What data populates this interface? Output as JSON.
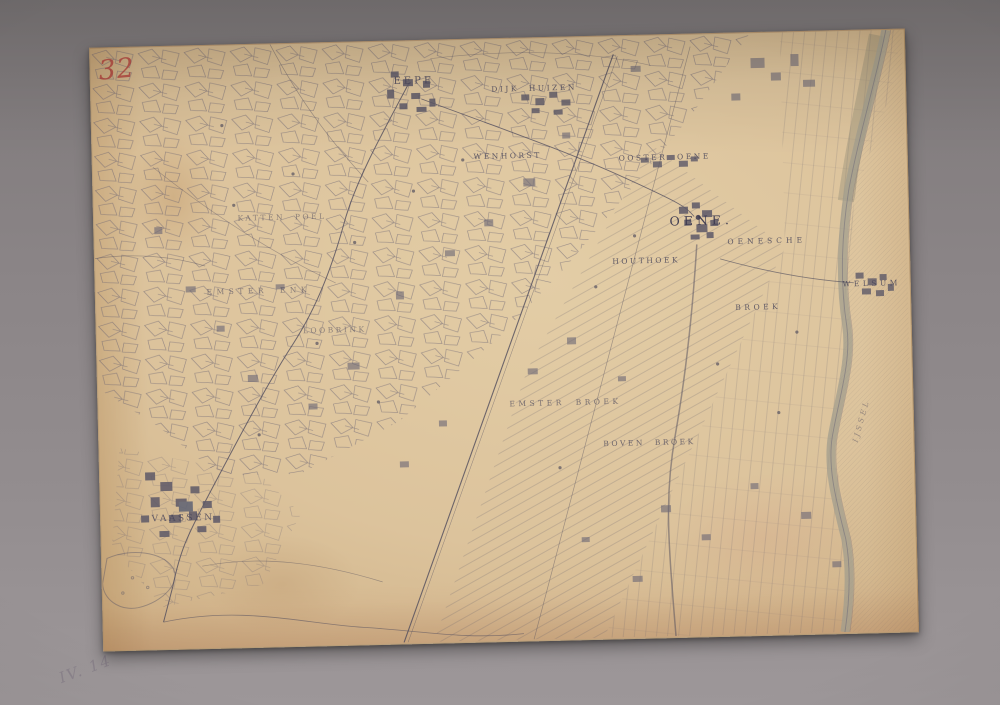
{
  "photo": {
    "pencil_note": "IV. 14",
    "background_color": "#8b8587"
  },
  "map": {
    "sheet_number": "32",
    "colors": {
      "paper": "#dcc39c",
      "ink": "#56525f",
      "sheet_number_red": "#b03e38",
      "river": "#a19d8e"
    },
    "labels": {
      "eepe": {
        "text": "EEPE"
      },
      "dijkhuizen": {
        "text": "DIJK HUIZEN"
      },
      "wenhorst": {
        "text": "WENHORST"
      },
      "ooster_oene": {
        "text": "OOSTER OENE"
      },
      "oene": {
        "text": "OENE."
      },
      "oenesche": {
        "text": "OENESCHE"
      },
      "houthoek": {
        "text": "HOUTHOEK"
      },
      "welsum": {
        "text": "WELSUM"
      },
      "broek": {
        "text": "BROEK"
      },
      "kattenpoel": {
        "text": "KATTEN POEL"
      },
      "emster_enk": {
        "text": "EMSTER ENK"
      },
      "loobrink": {
        "text": "LOOBRINK"
      },
      "emster_broek": {
        "text": "EMSTER BROEK"
      },
      "boven_broek": {
        "text": "BOVEN BROEK"
      },
      "vaassen": {
        "text": "VAASSEN"
      },
      "ijssel": {
        "text": "IJSSEL"
      }
    }
  }
}
